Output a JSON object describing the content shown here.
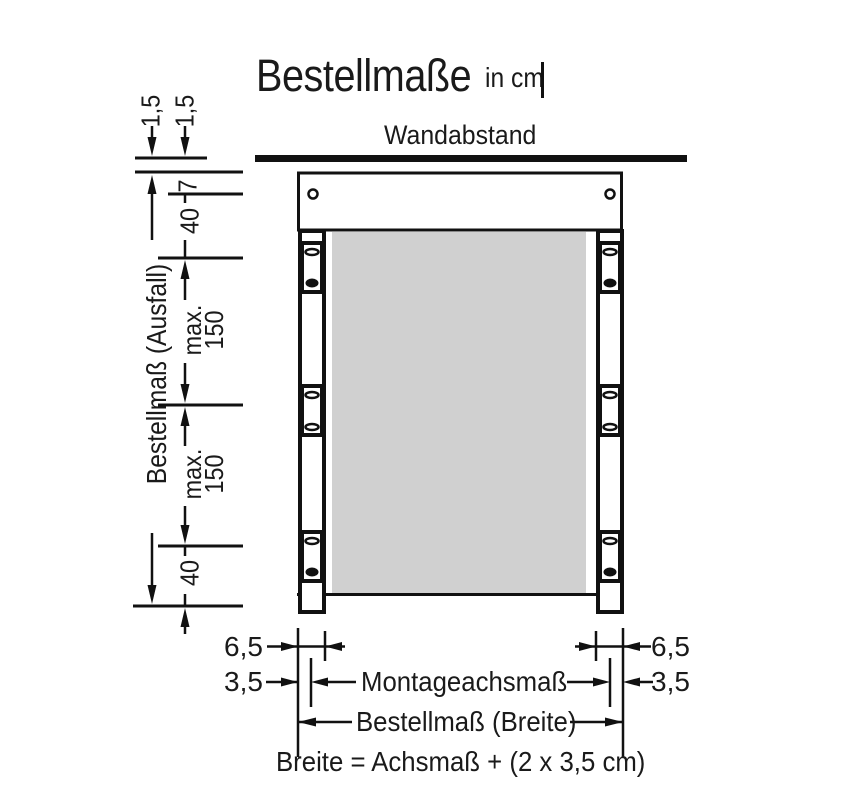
{
  "title": {
    "main": "Bestellmaße",
    "unit": "in cm"
  },
  "wall": {
    "label": "Wandabstand"
  },
  "left_dims": {
    "gap_a": "1,5",
    "gap_b": "1,5",
    "offset_7": "7",
    "top_40": "40",
    "ausfall_label": "Bestellmaß (Ausfall)",
    "max_1": {
      "line1": "max.",
      "line2": "150"
    },
    "max_2": {
      "line1": "max.",
      "line2": "150"
    },
    "bottom_40": "40"
  },
  "bottom_dims": {
    "left_6_5": "6,5",
    "left_3_5": "3,5",
    "right_6_5": "6,5",
    "right_3_5": "3,5",
    "axis_label": "Montageachsmaß",
    "width_label": "Bestellmaß (Breite)",
    "formula": "Breite = Achsmaß + (2 x 3,5 cm)"
  },
  "colors": {
    "ink": "#1a1a1a",
    "panel": "#d0d0d0"
  }
}
